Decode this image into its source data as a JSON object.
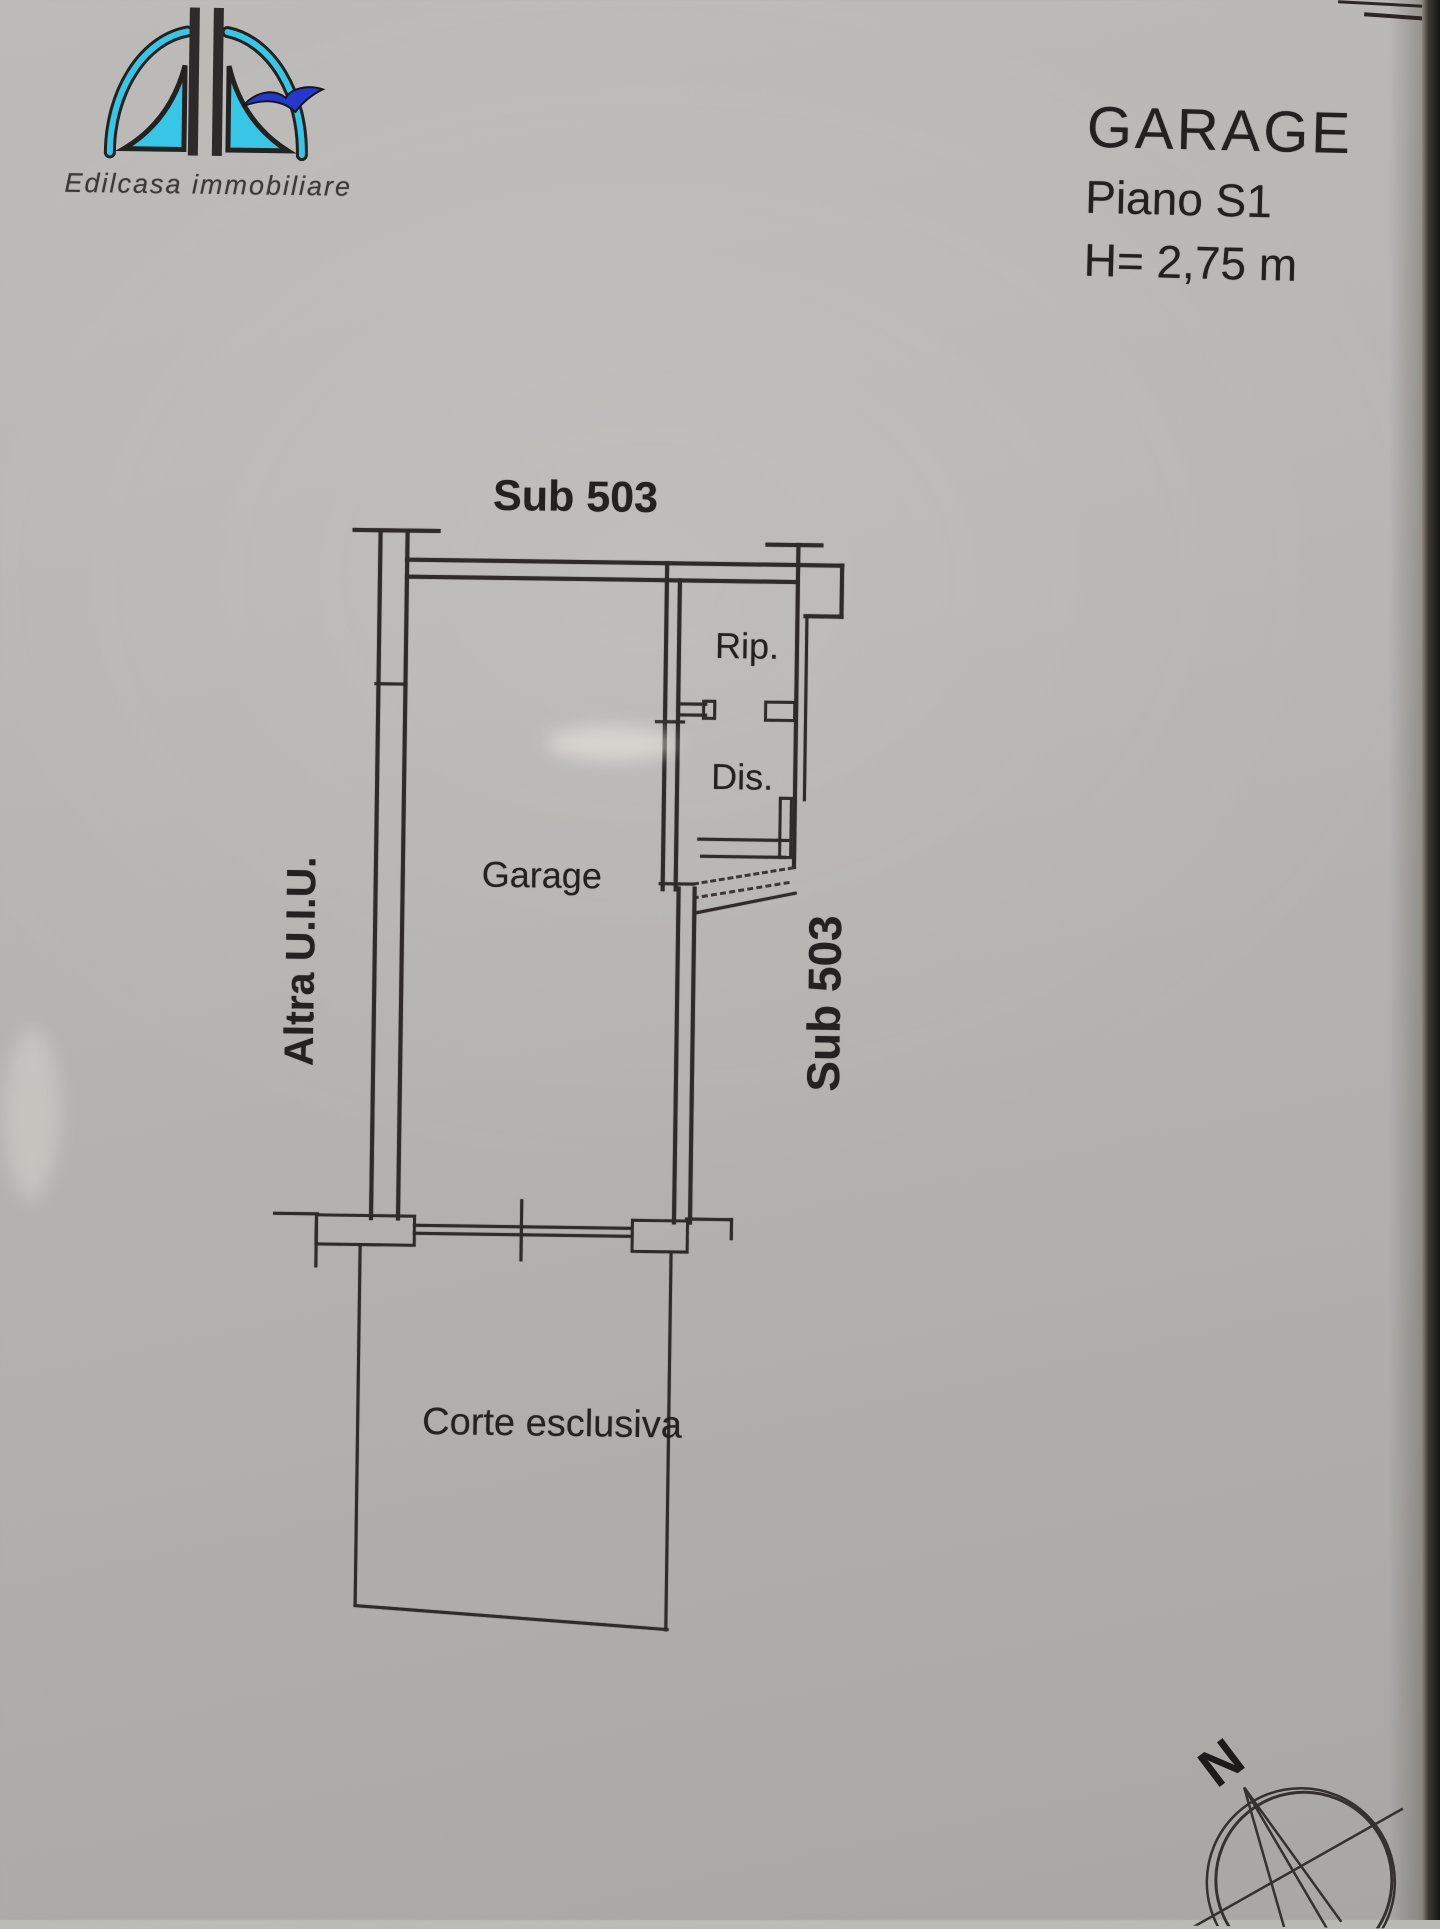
{
  "header": {
    "logo": {
      "brand": "Edilcasa immobiliare",
      "arc_color": "#38c6e6",
      "bird_color": "#2439cc",
      "bar_color": "#2d2b29"
    },
    "title_block": {
      "title": "GARAGE",
      "floor": "Piano S1",
      "height": "H= 2,75 m"
    }
  },
  "plan": {
    "labels": {
      "sub_top": "Sub 503",
      "room_rip": "Rip.",
      "room_dis": "Dis.",
      "room_garage": "Garage",
      "left_vertical": "Altra U.I.U.",
      "right_vertical": "Sub 503",
      "court": "Corte esclusiva"
    }
  },
  "compass": {
    "north_label": "N"
  },
  "colors": {
    "paper": "#b8b6b2",
    "ink": "#2e2b28",
    "scan_edge": "#171310"
  }
}
